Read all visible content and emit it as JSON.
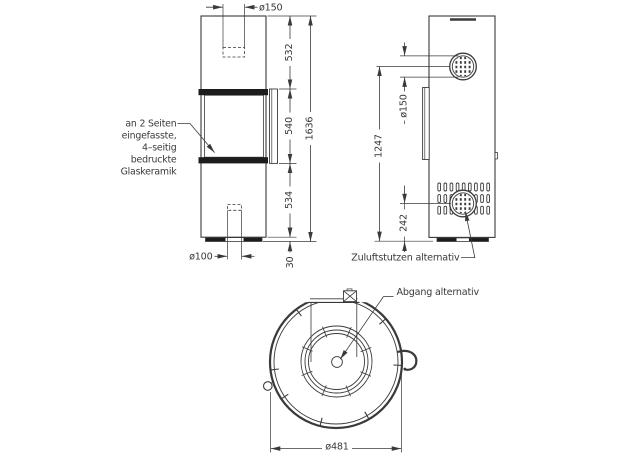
{
  "title": "stove-dimension-drawing",
  "colors": {
    "ink": "#3a3a3a",
    "band": "#1c1c1c",
    "background": "#ffffff"
  },
  "front_view": {
    "dim_top_flue_diameter": "ø150",
    "dim_upper_section": "532",
    "dim_glass_section": "540",
    "dim_lower_section": "534",
    "dim_plinth": "30",
    "dim_total_height": "1636",
    "dim_bottom_air_diameter": "ø100",
    "glass_note": [
      "an 2 Seiten",
      "eingefasste,",
      "4–seitig",
      "bedruckte",
      "Glaskeramik"
    ]
  },
  "side_view": {
    "dim_flue_diameter": "ø150",
    "dim_flue_center_height": "1247",
    "dim_inlet_center_height": "242",
    "label_air_inlet": "Zuluftstutzen  alternativ"
  },
  "top_view": {
    "label_outlet": "Abgang  alternativ",
    "dim_diameter": "ø481"
  }
}
